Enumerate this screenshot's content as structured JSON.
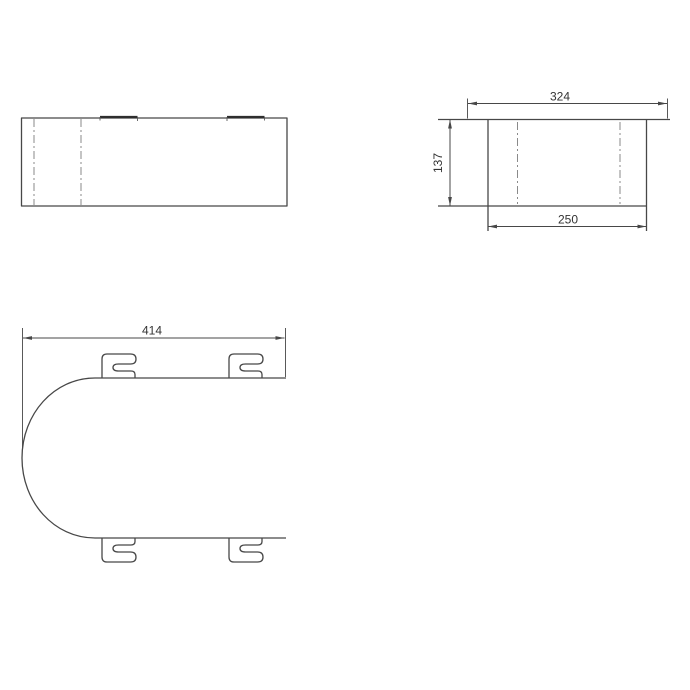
{
  "drawing": {
    "type": "technical-orthographic-drawing",
    "dimensions": {
      "flange_width": "324",
      "body_height": "137",
      "body_width": "250",
      "overall_width": "414"
    },
    "colors": {
      "background": "#ffffff",
      "line": "#474747",
      "centerline": "#8a8a8a",
      "dimension": "#474747"
    }
  }
}
